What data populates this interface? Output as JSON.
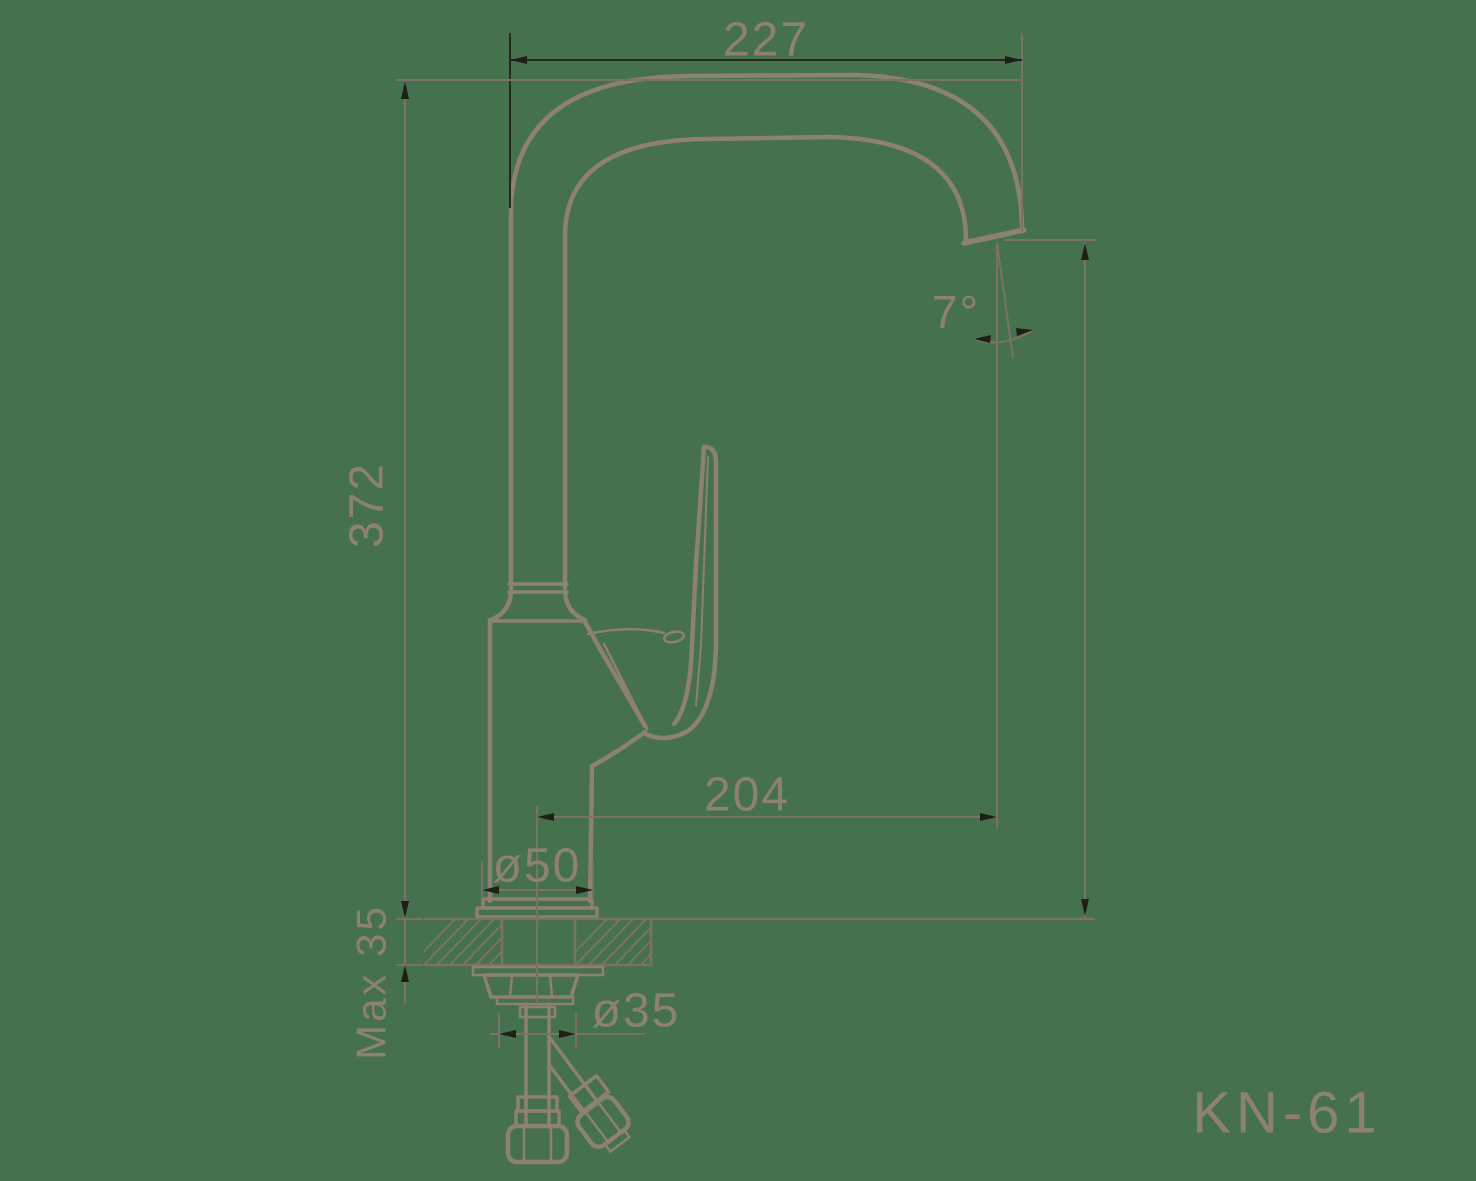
{
  "title": {
    "model": "KN-61"
  },
  "colors": {
    "background": "#46714D",
    "outline": "#8D8170",
    "thin": "#7A7365",
    "dark": "#26261E",
    "arrow": "#1F1F17",
    "text": "#8D8170"
  },
  "dimensions": {
    "spout_width": {
      "label": "227"
    },
    "total_height": {
      "label": "372"
    },
    "spout_reach": {
      "label": "204"
    },
    "base_diameter": {
      "label": "ø50"
    },
    "thread_diameter": {
      "label": "ø35"
    },
    "max_thickness": {
      "label": "Max 35"
    },
    "spout_angle": {
      "label": "7°"
    }
  }
}
